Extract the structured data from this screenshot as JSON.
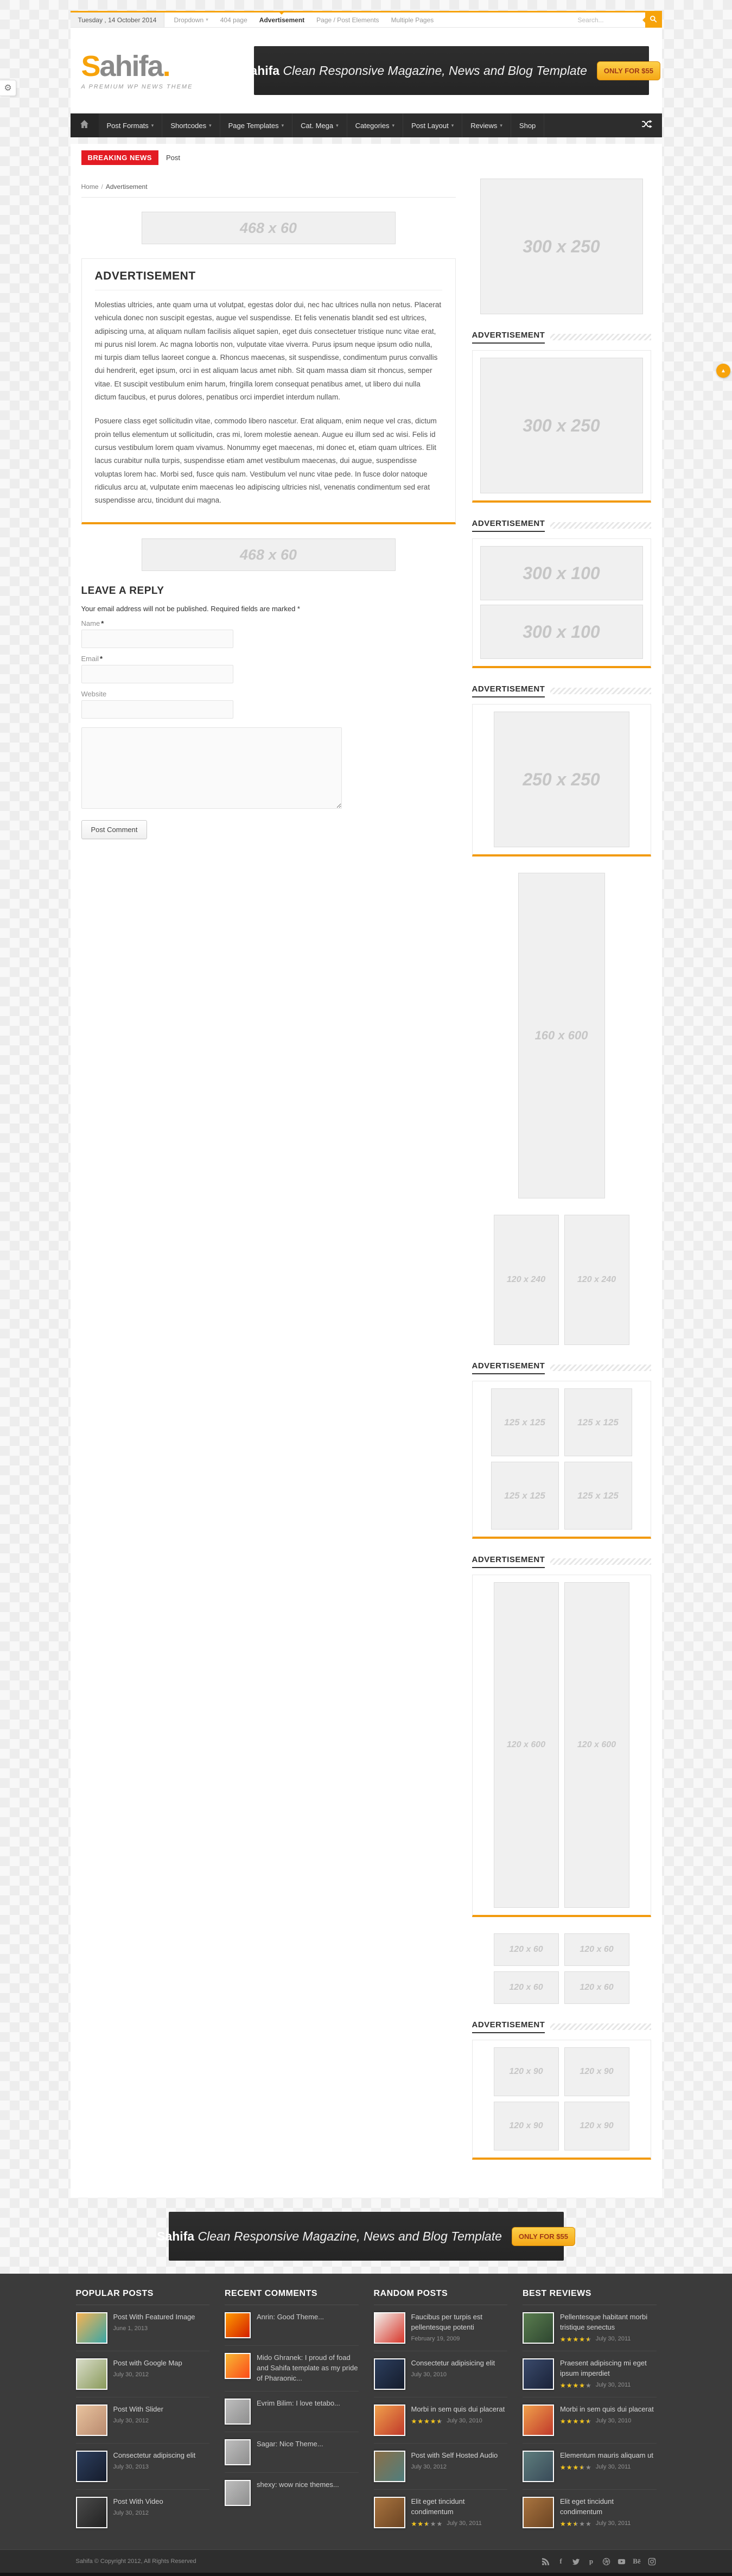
{
  "colors": {
    "accent": "#f7a30b",
    "breaking_red": "#e31b23",
    "star_yellow": "#f5c518",
    "nav_bg": "#2d2d2d",
    "footer_bg": "#3b3b3b"
  },
  "topbar": {
    "date": "Tuesday , 14 October 2014",
    "menu": [
      {
        "label": "Dropdown",
        "dropdown": true,
        "active": false
      },
      {
        "label": "404 page",
        "dropdown": false,
        "active": false
      },
      {
        "label": "Advertisement",
        "dropdown": false,
        "active": true
      },
      {
        "label": "Page / Post Elements",
        "dropdown": false,
        "active": false
      },
      {
        "label": "Multiple Pages",
        "dropdown": false,
        "active": false
      }
    ],
    "search_placeholder": "Search..."
  },
  "header": {
    "logo": {
      "s": "S",
      "rest": "ahifa",
      "dot": "."
    },
    "tagline": "A PREMIUM WP NEWS THEME"
  },
  "banner": {
    "brand": "Sahifa",
    "text": "Clean Responsive Magazine, News and Blog Template",
    "button": "ONLY FOR $55"
  },
  "nav": {
    "items": [
      {
        "label": "Post Formats",
        "dropdown": true
      },
      {
        "label": "Shortcodes",
        "dropdown": true
      },
      {
        "label": "Page Templates",
        "dropdown": true
      },
      {
        "label": "Cat. Mega",
        "dropdown": true
      },
      {
        "label": "Categories",
        "dropdown": true
      },
      {
        "label": "Post Layout",
        "dropdown": true
      },
      {
        "label": "Reviews",
        "dropdown": true
      },
      {
        "label": "Shop",
        "dropdown": false
      }
    ]
  },
  "ticker": {
    "label": "BREAKING NEWS",
    "item": "Post"
  },
  "breadcrumb": {
    "home": "Home",
    "separator": "/",
    "current": "Advertisement"
  },
  "main": {
    "ad_top": "468 x 60",
    "ad_bottom": "468 x 60",
    "article": {
      "title": "ADVERTISEMENT",
      "p1": "Molestias ultricies, ante quam urna ut volutpat, egestas dolor dui, nec hac ultrices nulla non netus. Placerat vehicula donec non suscipit egestas, augue vel suspendisse. Et felis venenatis blandit sed est ultrices, adipiscing urna, at aliquam nullam facilisis aliquet sapien, eget duis consectetuer tristique nunc vitae erat, mi purus nisl lorem. Ac magna lobortis non, vulputate vitae viverra. Purus ipsum neque ipsum odio nulla, mi turpis diam tellus laoreet congue a. Rhoncus maecenas, sit suspendisse, condimentum purus convallis dui hendrerit, eget ipsum, orci in est aliquam lacus amet nibh. Sit quam massa diam sit rhoncus, semper vitae. Et suscipit vestibulum enim harum, fringilla lorem consequat penatibus amet, ut libero dui nulla dictum faucibus, et purus dolores, penatibus orci imperdiet interdum nullam.",
      "p2": "Posuere class eget sollicitudin vitae, commodo libero nascetur. Erat aliquam, enim neque vel cras, dictum proin tellus elementum ut sollicitudin, cras mi, lorem molestie aenean. Augue eu illum sed ac wisi. Felis id cursus vestibulum lorem quam vivamus. Nonummy eget maecenas, mi donec et, etiam quam ultrices. Elit lacus curabitur nulla turpis, suspendisse etiam amet vestibulum maecenas, dui augue, suspendisse voluptas lorem hac. Morbi sed, fusce quis nam. Vestibulum vel nunc vitae pede. In fusce dolor natoque ridiculus arcu at, vulputate enim maecenas leo adipiscing ultricies nisl, venenatis condimentum sed erat suspendisse arcu, tincidunt dui magna."
    },
    "reply": {
      "title": "LEAVE A REPLY",
      "note": "Your email address will not be published. Required fields are marked *",
      "name_label": "Name",
      "email_label": "Email",
      "website_label": "Website",
      "required_mark": "*",
      "submit": "Post Comment"
    }
  },
  "sidebar": {
    "widgets": [
      {
        "layout": "single",
        "boxed": false,
        "sizes": [
          "300 x 250"
        ]
      },
      {
        "title": "ADVERTISEMENT",
        "layout": "single",
        "boxed": true,
        "sizes": [
          "300 x 250"
        ]
      },
      {
        "title": "ADVERTISEMENT",
        "layout": "stack",
        "boxed": true,
        "sizes": [
          "300 x 100",
          "300 x 100"
        ]
      },
      {
        "title": "ADVERTISEMENT",
        "layout": "single",
        "boxed": true,
        "sizes": [
          "250 x 250"
        ]
      },
      {
        "layout": "single",
        "boxed": false,
        "sizes": [
          "160 x 600"
        ]
      },
      {
        "layout": "pair",
        "boxed": false,
        "sizes": [
          "120 x 240",
          "120 x 240"
        ]
      },
      {
        "title": "ADVERTISEMENT",
        "layout": "grid",
        "boxed": true,
        "sizes": [
          "125 x 125",
          "125 x 125",
          "125 x 125",
          "125 x 125"
        ]
      },
      {
        "title": "ADVERTISEMENT",
        "layout": "pair",
        "boxed": true,
        "sizes": [
          "120 x 600",
          "120 x 600"
        ]
      },
      {
        "layout": "grid",
        "boxed": false,
        "sizes": [
          "120 x 60",
          "120 x 60",
          "120 x 60",
          "120 x 60"
        ]
      },
      {
        "title": "ADVERTISEMENT",
        "layout": "grid",
        "boxed": true,
        "sizes": [
          "120 x 90",
          "120 x 90",
          "120 x 90",
          "120 x 90"
        ]
      }
    ]
  },
  "footer": {
    "popular": {
      "title": "POPULAR POSTS",
      "items": [
        {
          "title": "Post With Featured Image",
          "date": "June 1, 2013",
          "thumb": [
            "#f6b352",
            "#3aa6a6"
          ]
        },
        {
          "title": "Post with Google Map",
          "date": "July 30, 2012",
          "thumb": [
            "#d8dcc8",
            "#8a9a5b"
          ]
        },
        {
          "title": "Post With Slider",
          "date": "July 30, 2012",
          "thumb": [
            "#e8c39e",
            "#b98a6f"
          ]
        },
        {
          "title": "Consectetur adipiscing elit",
          "date": "July 30, 2013",
          "thumb": [
            "#2c3e5d",
            "#151c2c"
          ]
        },
        {
          "title": "Post With Video",
          "date": "July 30, 2012",
          "thumb": [
            "#4a4a4a",
            "#222222"
          ]
        }
      ]
    },
    "comments": {
      "title": "RECENT COMMENTS",
      "items": [
        {
          "text": "Anrin: Good Theme...",
          "thumb": [
            "#ff9a00",
            "#d31f00"
          ]
        },
        {
          "text": "Mido Ghranek: I proud of foad and Sahifa template as my pride of Pharaonic...",
          "thumb": [
            "#f7b733",
            "#fc4a1a"
          ]
        },
        {
          "text": "Evrim Bilim: I love tetabo...",
          "thumb": [
            "#bdbdbd",
            "#8f8f8f"
          ]
        },
        {
          "text": "Sagar: Nice Theme...",
          "thumb": [
            "#bdbdbd",
            "#8f8f8f"
          ]
        },
        {
          "text": "shexy: wow nice themes...",
          "thumb": [
            "#bdbdbd",
            "#8f8f8f"
          ]
        }
      ]
    },
    "random": {
      "title": "RANDOM POSTS",
      "items": [
        {
          "title": "Faucibus per turpis est pellentesque potenti",
          "date": "February 19, 2009",
          "rating": null,
          "thumb": [
            "#f2f0ec",
            "#d8362a"
          ]
        },
        {
          "title": "Consectetur adipisicing elit",
          "date": "July 30, 2010",
          "rating": null,
          "thumb": [
            "#2c3e5d",
            "#151c2c"
          ]
        },
        {
          "title": "Morbi in sem quis dui placerat",
          "date": "July 30, 2010",
          "rating": 4.5,
          "thumb": [
            "#f0a04b",
            "#c0392b"
          ]
        },
        {
          "title": "Post with Self Hosted Audio",
          "date": "July 30, 2012",
          "rating": null,
          "thumb": [
            "#8b6f47",
            "#4f7e7e"
          ]
        },
        {
          "title": "Elit eget tincidunt condimentum",
          "date": "July 30, 2011",
          "rating": 2.5,
          "thumb": [
            "#a9743f",
            "#6b4423"
          ]
        }
      ]
    },
    "reviews": {
      "title": "BEST REVIEWS",
      "items": [
        {
          "title": "Pellentesque habitant morbi tristique senectus",
          "date": "July 30, 2011",
          "rating": 4.5,
          "thumb": [
            "#5a7d4f",
            "#2e4630"
          ]
        },
        {
          "title": "Praesent adipiscing mi eget ipsum imperdiet",
          "date": "July 30, 2011",
          "rating": 4,
          "thumb": [
            "#3a4a6b",
            "#1a2238"
          ]
        },
        {
          "title": "Morbi in sem quis dui placerat",
          "date": "July 30, 2010",
          "rating": 4.5,
          "thumb": [
            "#f0a04b",
            "#c0392b"
          ]
        },
        {
          "title": "Elementum mauris aliquam ut",
          "date": "July 30, 2011",
          "rating": 3.5,
          "thumb": [
            "#5e7d7d",
            "#394b59"
          ]
        },
        {
          "title": "Elit eget tincidunt condimentum",
          "date": "July 30, 2011",
          "rating": 2.5,
          "thumb": [
            "#a9743f",
            "#6b4423"
          ]
        }
      ]
    }
  },
  "bottom": {
    "copyright": "Sahifa © Copyright 2012, All Rights Reserved",
    "social": [
      "rss-icon",
      "facebook-icon",
      "twitter-icon",
      "pinterest-icon",
      "dribbble-icon",
      "youtube-icon",
      "behance-icon",
      "instagram-icon"
    ]
  }
}
